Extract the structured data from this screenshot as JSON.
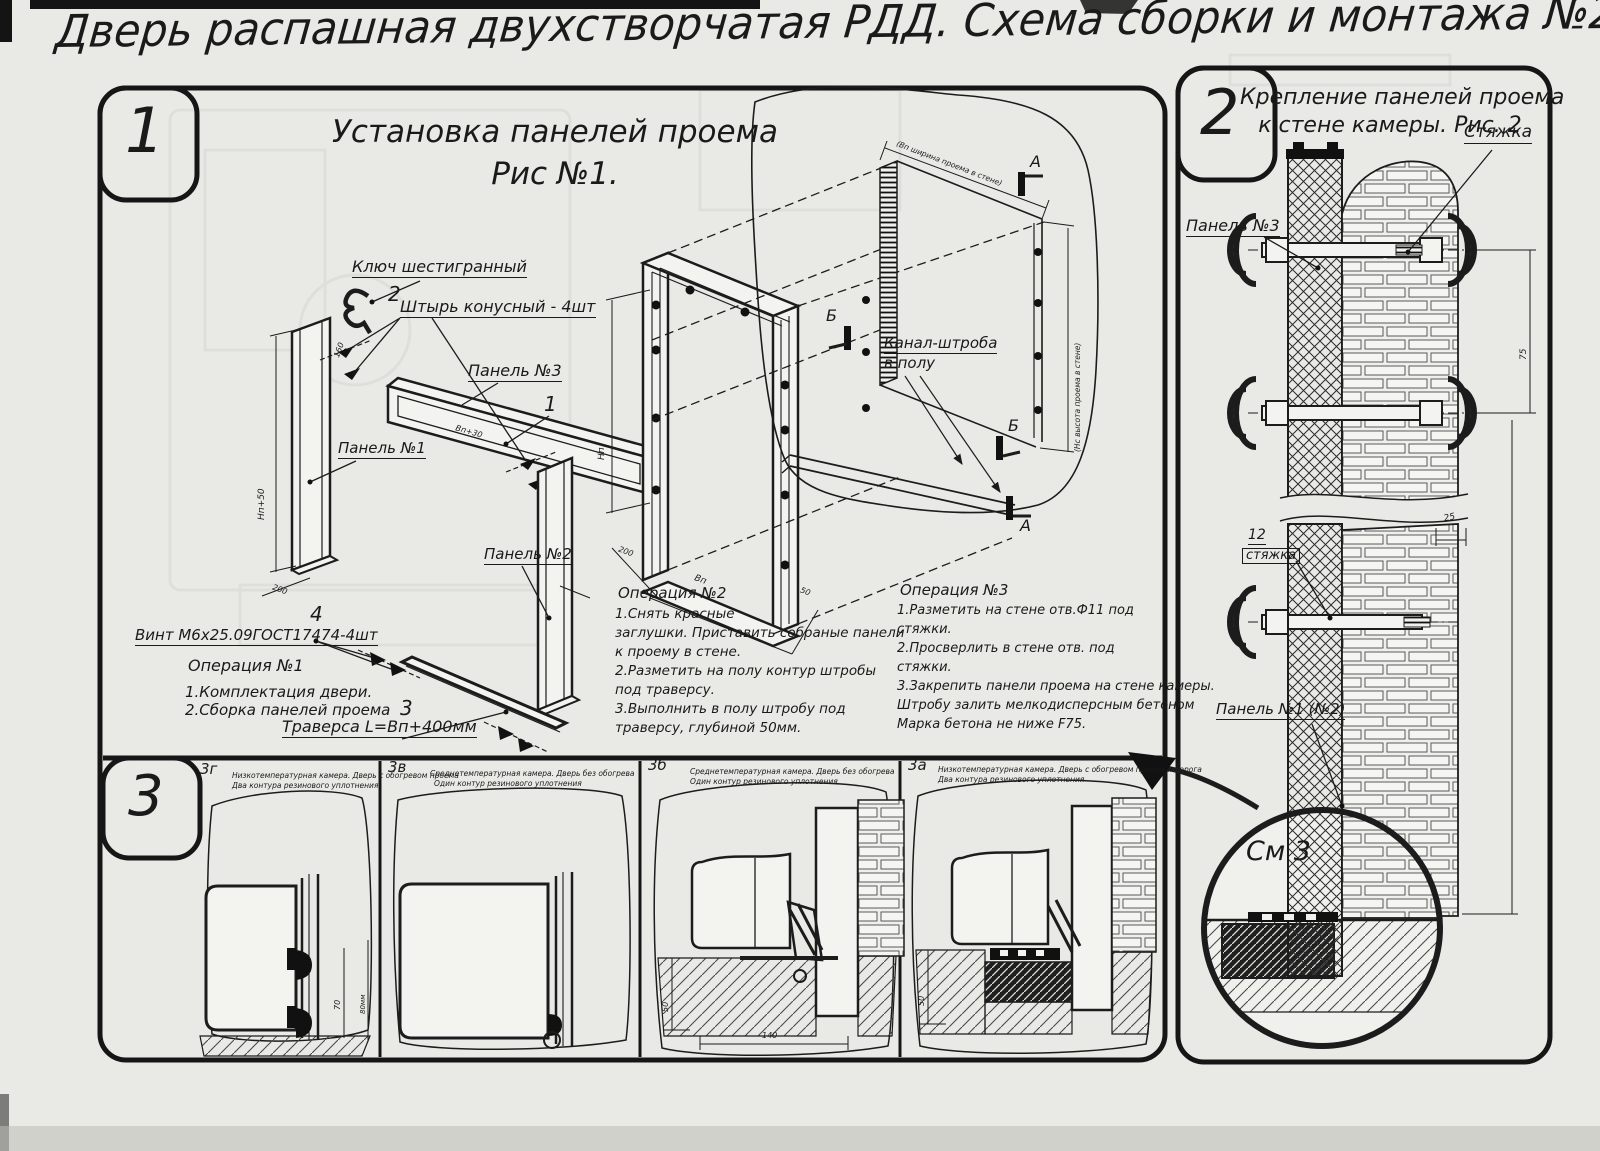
{
  "title": "Дверь распашная двухстворчатая РДД.  Схема сборки и монтажа №2",
  "section1": {
    "badge": "1",
    "heading1": "Установка панелей проема",
    "heading2": "Рис №1.",
    "labels": {
      "hexkey": "Ключ шестигранный",
      "pin_no": "2",
      "pin": "Штырь конусный - 4шт",
      "panel3": "Панель №3",
      "callout1": "1",
      "panel1": "Панель №1",
      "panel2": "Панель №2",
      "screw_no": "4",
      "screw": "Винт М6х25.09ГОСТ17474-4шт",
      "traverse_no": "3",
      "traverse": "Траверса  L=Вп+400мм",
      "channel1": "Канал-штроба",
      "channel2": "в полу",
      "sect_a": "А",
      "sect_a2": "А",
      "sect_b": "Б",
      "sect_b2": "Б",
      "wall_w": "(Вп ширина проема в стене)",
      "wall_h": "(Нс высота проема в стене)",
      "dim_np50": "Нп+50",
      "dim_200a": "200",
      "dim_160": "160",
      "dim_np": "Нп",
      "dim_200b": "200",
      "dim_vp": "Вп",
      "dim_50": "50",
      "dim_vp30": "Вп+30"
    },
    "op1": {
      "title": "Операция №1",
      "lines": [
        "1.Комплектация двери.",
        "2.Сборка панелей проема"
      ]
    },
    "op2": {
      "title": "Операция №2",
      "lines": [
        "1.Снять красные",
        "заглушки. Приставить собраные панели",
        "к проему в стене.",
        "2.Разметить на полу контур штробы",
        "под траверсу.",
        "3.Выполнить в полу штробу под",
        "траверсу, глубиной 50мм."
      ]
    },
    "op3": {
      "title": "Операция №3",
      "lines": [
        "1.Разметить на стене отв.Ф11 под",
        "стяжки.",
        "2.Просверлить в стене отв.  под",
        "стяжки.",
        "3.Закрепить панели проема на стене камеры.",
        "Штробу залить мелкодисперсным бетоном",
        "Марка бетона не ниже  F75."
      ]
    }
  },
  "section2": {
    "badge": "2",
    "heading1": "Крепление панелей проема",
    "heading2": "к стене камеры. Рис. 2",
    "labels": {
      "tie": "Стяжка",
      "panel3": "Панель №3",
      "tie12_no": "12",
      "tie12": "стяжка",
      "panel12": "Панель №1 (№2)",
      "see3": "См 3",
      "dim25": "25",
      "dim75": "75"
    }
  },
  "section3": {
    "badge": "3",
    "panels": [
      {
        "id": "3г",
        "line1": "Низкотемпературная камера. Дверь с обогревом проема",
        "line2": "Два контура резинового уплотнения",
        "dim_a": "70",
        "dim_b": "80мм"
      },
      {
        "id": "3в",
        "line1": "Среднетемпературная камера. Дверь без обогрева",
        "line2": "Один контур резинового уплотнения"
      },
      {
        "id": "3б",
        "line1": "Среднетемпературная камера. Дверь без обогрева",
        "line2": "Один контур резинового уплотнения",
        "dim_a": "50",
        "dim_b": "140"
      },
      {
        "id": "3а",
        "line1": "Низкотемпературная камера. Дверь с обогревом проема и порога",
        "line2": "Два контура резинового уплотнения",
        "dim_a": "50"
      }
    ]
  },
  "ink_color": "#1a1a1a",
  "paper_color": "#e9e9e5"
}
